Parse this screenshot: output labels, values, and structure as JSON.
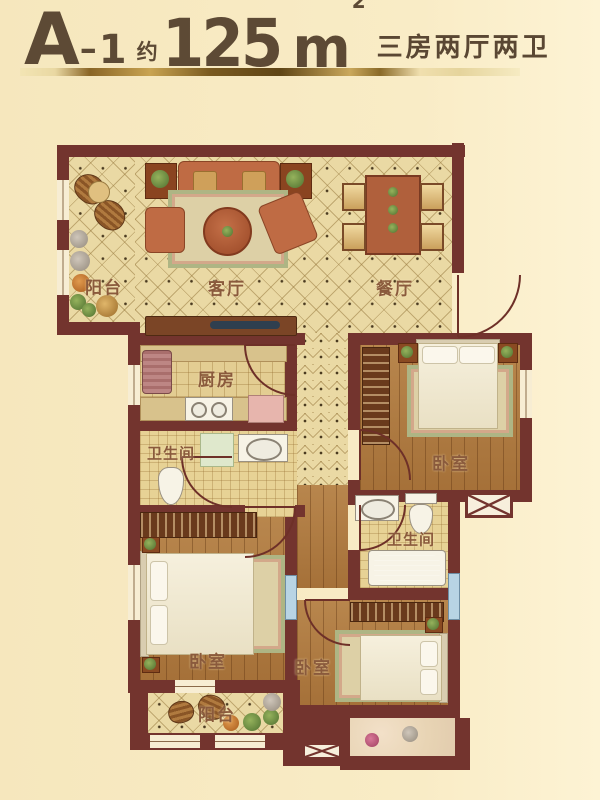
{
  "header": {
    "unit": "A",
    "dash": "–",
    "number": "1",
    "approx": "约",
    "area": "125",
    "area_unit": "m",
    "area_sup": "2",
    "subtitle": "三房两厅两卫"
  },
  "rooms": {
    "balcony_top": {
      "label": "阳台"
    },
    "living": {
      "label": "客厅"
    },
    "dining": {
      "label": "餐厅"
    },
    "kitchen": {
      "label": "厨房"
    },
    "bath1": {
      "label": "卫生间"
    },
    "bedroom1": {
      "label": "卧室"
    },
    "bath2": {
      "label": "卫生间"
    },
    "bedroom2": {
      "label": "卧室"
    },
    "bedroom3": {
      "label": "卧室"
    },
    "balcony_bottom": {
      "label": "阳台"
    }
  },
  "colors": {
    "background": "#f8ebc4",
    "wall": "#73342e",
    "gold_bar": "#c9a452",
    "title_text": "#5d4a35",
    "room_label_text": "#8a5a3c",
    "tile_floor": "#ead9a4",
    "wood_floor": "#b07a3f",
    "bathtub_blue": "#4a9ad4"
  }
}
